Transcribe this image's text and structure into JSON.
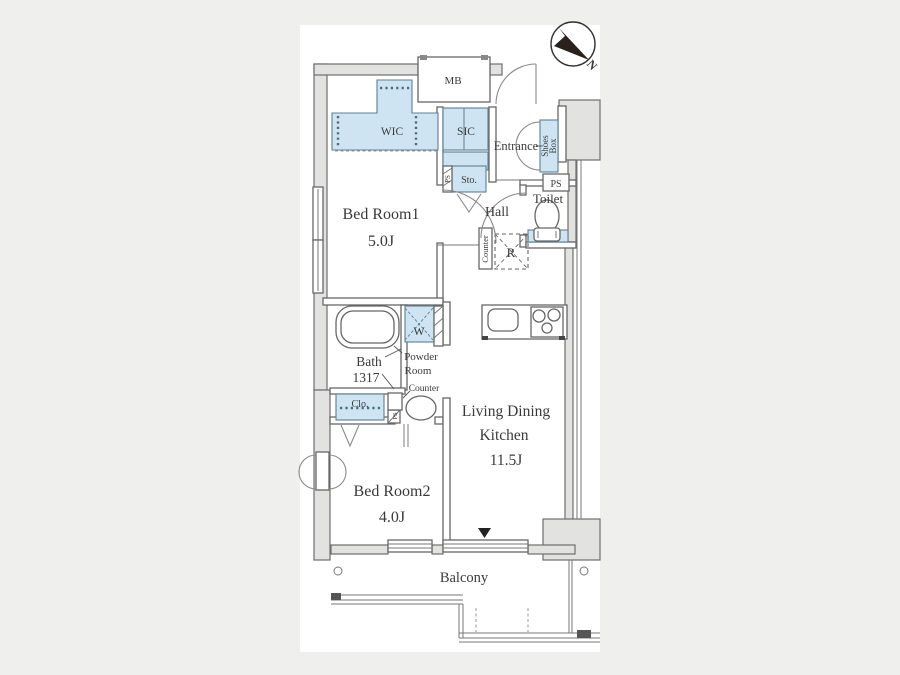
{
  "meta": {
    "type": "floor-plan",
    "colors": {
      "page_background": "#eff0ee",
      "canvas": "#ffffff",
      "wall_fill": "#e2e3e0",
      "wall_line": "#6e6e6e",
      "closet_fill": "#cfe4f2",
      "closet_line": "#5d7f94",
      "text": "#3a3a3a",
      "compass_needle": "#2a211c"
    }
  },
  "compass": {
    "north": "N"
  },
  "labels": {
    "mb": "MB",
    "wic": "WIC",
    "sic": "SIC",
    "entrance": "Entrance",
    "shoes_line1": "Shoes",
    "shoes_line2": "Box",
    "ps": "PS",
    "sto": "Sto.",
    "toilet": "Toilet",
    "hall": "Hall",
    "bedroom1_name": "Bed Room1",
    "bedroom1_size": "5.0J",
    "counter": "Counter",
    "fridge": "R",
    "bath_name": "Bath",
    "bath_size": "1317",
    "washer": "W",
    "powder_line1": "Powder",
    "powder_line2": "Room",
    "clo": "Clo.",
    "ldk_line1": "Living Dining",
    "ldk_line2": "Kitchen",
    "ldk_size": "11.5J",
    "bedroom2_name": "Bed Room2",
    "bedroom2_size": "4.0J",
    "balcony": "Balcony"
  }
}
